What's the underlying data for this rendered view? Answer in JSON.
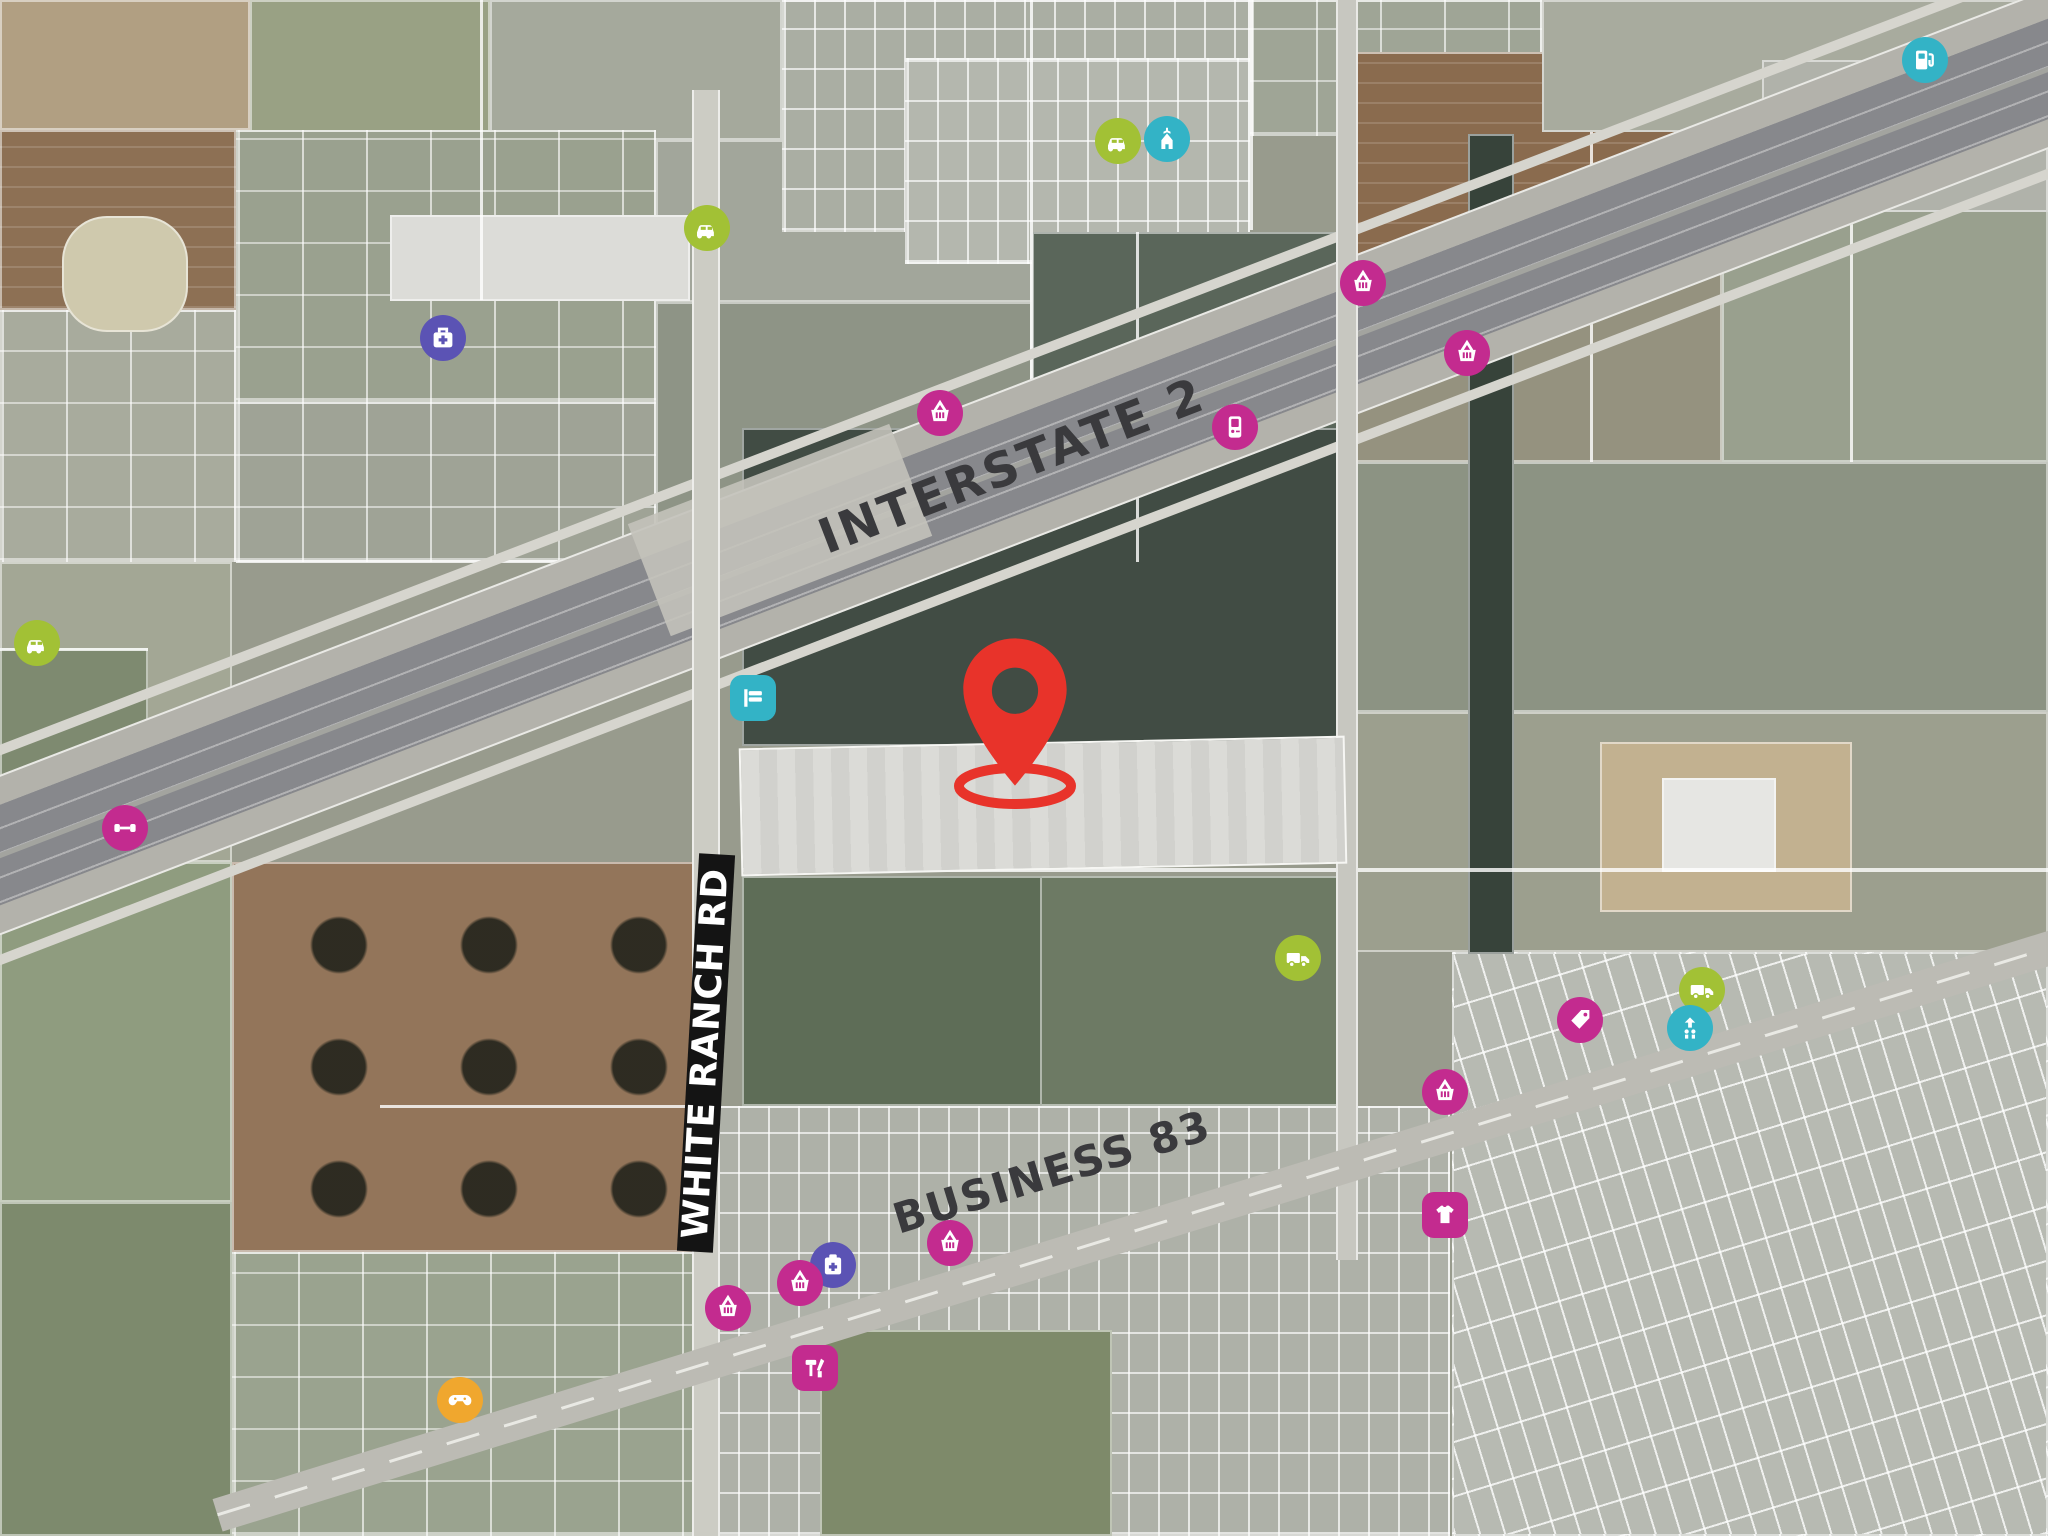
{
  "map": {
    "description": "Aerial site map with subject-property pin, Interstate 2, Business 83 and retail points of interest",
    "road_labels": [
      {
        "id": "interstate-2",
        "text": "INTERSTATE 2"
      },
      {
        "id": "business-83",
        "text": "BUSINESS 83"
      },
      {
        "id": "white-ranch-rd",
        "text": "WHITE RANCH RD"
      }
    ],
    "pin": {
      "name": "subject-site-pin",
      "color": "#e8332a"
    },
    "label_colors": {
      "road_text": "#3a3a3d",
      "band_bg": "#141414",
      "band_text": "#ffffff"
    },
    "poi_colors": {
      "magenta": "#c32b8f",
      "lime": "#a2c135",
      "cyan": "#33b3c6",
      "indigo": "#5b53b4",
      "amber": "#f0a72e"
    },
    "pois": [
      {
        "icon": "gas-pump",
        "color": "cyan",
        "x": 1925,
        "y": 60
      },
      {
        "icon": "car-dealer",
        "color": "lime",
        "x": 1118,
        "y": 141
      },
      {
        "icon": "church",
        "color": "cyan",
        "x": 1167,
        "y": 139
      },
      {
        "icon": "car-dealer",
        "color": "lime",
        "x": 707,
        "y": 228
      },
      {
        "icon": "medical-bag",
        "color": "indigo",
        "x": 443,
        "y": 338
      },
      {
        "icon": "shopping-basket",
        "color": "magenta",
        "x": 1363,
        "y": 283
      },
      {
        "icon": "shopping-basket",
        "color": "magenta",
        "x": 1467,
        "y": 353
      },
      {
        "icon": "shopping-basket",
        "color": "magenta",
        "x": 940,
        "y": 413
      },
      {
        "icon": "game-console",
        "color": "magenta",
        "x": 1235,
        "y": 427
      },
      {
        "icon": "car-dealer",
        "color": "lime",
        "x": 37,
        "y": 643
      },
      {
        "icon": "gym-dumbbell",
        "color": "magenta",
        "x": 125,
        "y": 828
      },
      {
        "icon": "motel-bed",
        "color": "cyan",
        "x": 753,
        "y": 698,
        "shape": "square"
      },
      {
        "icon": "truck",
        "color": "lime",
        "x": 1298,
        "y": 958
      },
      {
        "icon": "truck",
        "color": "lime",
        "x": 1702,
        "y": 990
      },
      {
        "icon": "car-wash",
        "color": "cyan",
        "x": 1690,
        "y": 1028
      },
      {
        "icon": "price-tag",
        "color": "magenta",
        "x": 1580,
        "y": 1020
      },
      {
        "icon": "shopping-basket",
        "color": "magenta",
        "x": 1445,
        "y": 1092
      },
      {
        "icon": "shopping-basket",
        "color": "magenta",
        "x": 950,
        "y": 1243
      },
      {
        "icon": "pharmacy",
        "color": "indigo",
        "x": 833,
        "y": 1265
      },
      {
        "icon": "shopping-basket",
        "color": "magenta",
        "x": 800,
        "y": 1283
      },
      {
        "icon": "shopping-basket",
        "color": "magenta",
        "x": 728,
        "y": 1308
      },
      {
        "icon": "hardware-tools",
        "color": "magenta",
        "x": 815,
        "y": 1368,
        "shape": "square"
      },
      {
        "icon": "clothing-tshirt",
        "color": "magenta",
        "x": 1445,
        "y": 1215,
        "shape": "square"
      },
      {
        "icon": "gamepad",
        "color": "amber",
        "x": 460,
        "y": 1400
      }
    ]
  }
}
